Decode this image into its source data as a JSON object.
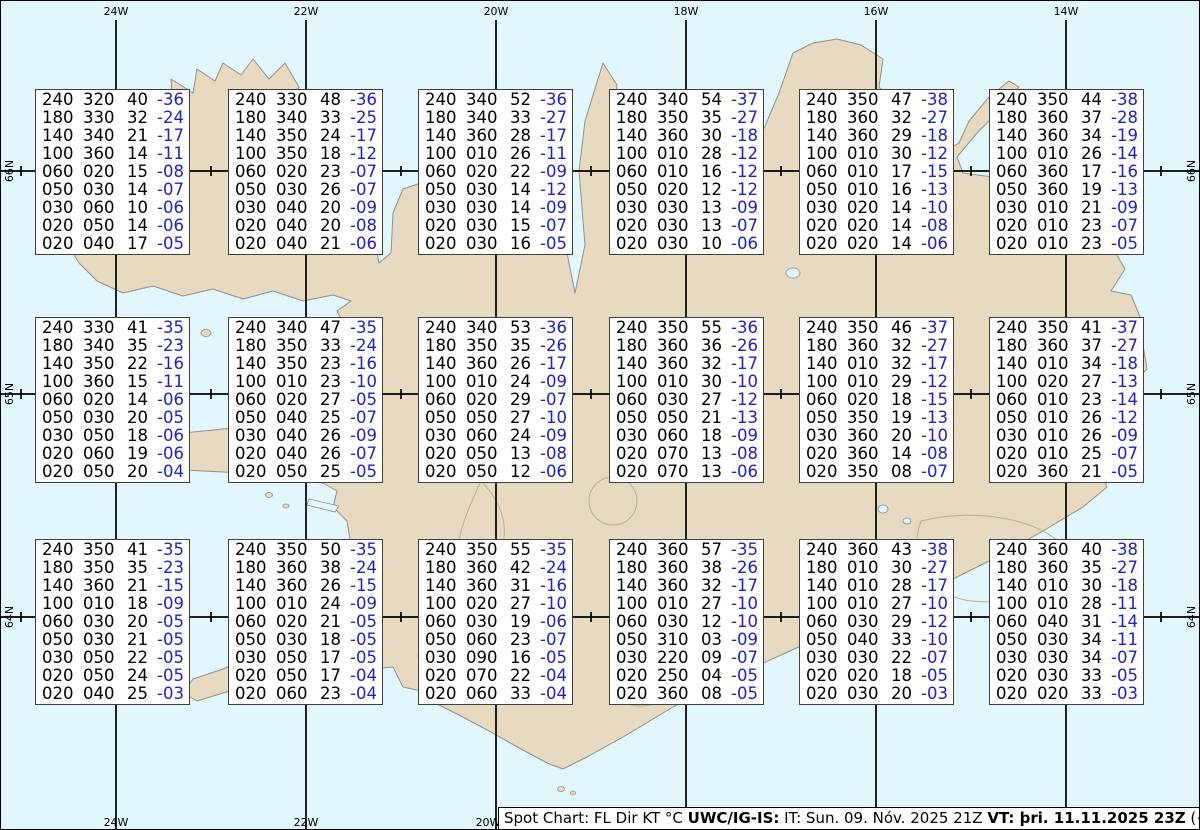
{
  "graticule": {
    "top_labels": [
      "24W",
      "22W",
      "20W",
      "18W",
      "16W",
      "14W"
    ],
    "bottom_labels": [
      "24W",
      "22W",
      "20W"
    ],
    "left_labels": [
      "66N",
      "65N",
      "64N"
    ],
    "right_labels": [
      "66N",
      "65N",
      "64N"
    ]
  },
  "legend_columns": [
    "FL",
    "Dir",
    "KT",
    "°C"
  ],
  "colors": {
    "water": "#e1f7fc",
    "land": "#e8d9c1",
    "coastline": "#919191",
    "temperature_blue": "#2222bf",
    "grid_black": "#000000",
    "box_border": "#3f3f3f"
  },
  "spot_boxes": [
    {
      "rows": [
        [
          "240",
          "320",
          "40",
          "-36"
        ],
        [
          "180",
          "330",
          "32",
          "-24"
        ],
        [
          "140",
          "340",
          "21",
          "-17"
        ],
        [
          "100",
          "360",
          "14",
          "-11"
        ],
        [
          "060",
          "020",
          "15",
          "-08"
        ],
        [
          "050",
          "030",
          "14",
          "-07"
        ],
        [
          "030",
          "060",
          "10",
          "-06"
        ],
        [
          "020",
          "050",
          "14",
          "-06"
        ],
        [
          "020",
          "040",
          "17",
          "-05"
        ]
      ]
    },
    {
      "rows": [
        [
          "240",
          "330",
          "48",
          "-36"
        ],
        [
          "180",
          "340",
          "33",
          "-25"
        ],
        [
          "140",
          "350",
          "24",
          "-17"
        ],
        [
          "100",
          "350",
          "18",
          "-12"
        ],
        [
          "060",
          "020",
          "23",
          "-07"
        ],
        [
          "050",
          "030",
          "26",
          "-07"
        ],
        [
          "030",
          "040",
          "20",
          "-09"
        ],
        [
          "020",
          "040",
          "20",
          "-08"
        ],
        [
          "020",
          "040",
          "21",
          "-06"
        ]
      ]
    },
    {
      "rows": [
        [
          "240",
          "340",
          "52",
          "-36"
        ],
        [
          "180",
          "340",
          "33",
          "-27"
        ],
        [
          "140",
          "360",
          "28",
          "-17"
        ],
        [
          "100",
          "010",
          "26",
          "-11"
        ],
        [
          "060",
          "020",
          "22",
          "-09"
        ],
        [
          "050",
          "030",
          "14",
          "-12"
        ],
        [
          "030",
          "030",
          "14",
          "-09"
        ],
        [
          "020",
          "030",
          "15",
          "-07"
        ],
        [
          "020",
          "030",
          "16",
          "-05"
        ]
      ]
    },
    {
      "rows": [
        [
          "240",
          "340",
          "54",
          "-37"
        ],
        [
          "180",
          "350",
          "35",
          "-27"
        ],
        [
          "140",
          "360",
          "30",
          "-18"
        ],
        [
          "100",
          "010",
          "28",
          "-12"
        ],
        [
          "060",
          "010",
          "16",
          "-12"
        ],
        [
          "050",
          "020",
          "12",
          "-12"
        ],
        [
          "030",
          "030",
          "13",
          "-09"
        ],
        [
          "020",
          "030",
          "13",
          "-07"
        ],
        [
          "020",
          "030",
          "10",
          "-06"
        ]
      ]
    },
    {
      "rows": [
        [
          "240",
          "350",
          "47",
          "-38"
        ],
        [
          "180",
          "360",
          "32",
          "-27"
        ],
        [
          "140",
          "360",
          "29",
          "-18"
        ],
        [
          "100",
          "010",
          "30",
          "-12"
        ],
        [
          "060",
          "010",
          "17",
          "-15"
        ],
        [
          "050",
          "010",
          "16",
          "-13"
        ],
        [
          "030",
          "020",
          "14",
          "-10"
        ],
        [
          "020",
          "020",
          "14",
          "-08"
        ],
        [
          "020",
          "020",
          "14",
          "-06"
        ]
      ]
    },
    {
      "rows": [
        [
          "240",
          "350",
          "44",
          "-38"
        ],
        [
          "180",
          "360",
          "37",
          "-28"
        ],
        [
          "140",
          "360",
          "34",
          "-19"
        ],
        [
          "100",
          "010",
          "26",
          "-14"
        ],
        [
          "060",
          "360",
          "17",
          "-16"
        ],
        [
          "050",
          "360",
          "19",
          "-13"
        ],
        [
          "030",
          "010",
          "21",
          "-09"
        ],
        [
          "020",
          "010",
          "23",
          "-07"
        ],
        [
          "020",
          "010",
          "23",
          "-05"
        ]
      ]
    },
    {
      "rows": [
        [
          "240",
          "330",
          "41",
          "-35"
        ],
        [
          "180",
          "340",
          "35",
          "-23"
        ],
        [
          "140",
          "350",
          "22",
          "-16"
        ],
        [
          "100",
          "360",
          "15",
          "-11"
        ],
        [
          "060",
          "020",
          "14",
          "-06"
        ],
        [
          "050",
          "030",
          "20",
          "-05"
        ],
        [
          "030",
          "050",
          "18",
          "-06"
        ],
        [
          "020",
          "060",
          "19",
          "-06"
        ],
        [
          "020",
          "050",
          "20",
          "-04"
        ]
      ]
    },
    {
      "rows": [
        [
          "240",
          "340",
          "47",
          "-35"
        ],
        [
          "180",
          "350",
          "33",
          "-24"
        ],
        [
          "140",
          "350",
          "23",
          "-16"
        ],
        [
          "100",
          "010",
          "23",
          "-10"
        ],
        [
          "060",
          "020",
          "27",
          "-05"
        ],
        [
          "050",
          "040",
          "25",
          "-07"
        ],
        [
          "030",
          "040",
          "26",
          "-09"
        ],
        [
          "020",
          "040",
          "26",
          "-07"
        ],
        [
          "020",
          "050",
          "25",
          "-05"
        ]
      ]
    },
    {
      "rows": [
        [
          "240",
          "340",
          "53",
          "-36"
        ],
        [
          "180",
          "350",
          "35",
          "-26"
        ],
        [
          "140",
          "360",
          "26",
          "-17"
        ],
        [
          "100",
          "010",
          "24",
          "-09"
        ],
        [
          "060",
          "020",
          "29",
          "-07"
        ],
        [
          "050",
          "050",
          "27",
          "-10"
        ],
        [
          "030",
          "060",
          "24",
          "-09"
        ],
        [
          "020",
          "050",
          "13",
          "-08"
        ],
        [
          "020",
          "050",
          "12",
          "-06"
        ]
      ]
    },
    {
      "rows": [
        [
          "240",
          "350",
          "55",
          "-36"
        ],
        [
          "180",
          "360",
          "36",
          "-26"
        ],
        [
          "140",
          "360",
          "32",
          "-17"
        ],
        [
          "100",
          "010",
          "30",
          "-10"
        ],
        [
          "060",
          "030",
          "27",
          "-12"
        ],
        [
          "050",
          "050",
          "21",
          "-13"
        ],
        [
          "030",
          "060",
          "18",
          "-09"
        ],
        [
          "020",
          "070",
          "13",
          "-08"
        ],
        [
          "020",
          "070",
          "13",
          "-06"
        ]
      ]
    },
    {
      "rows": [
        [
          "240",
          "350",
          "46",
          "-37"
        ],
        [
          "180",
          "360",
          "32",
          "-27"
        ],
        [
          "140",
          "010",
          "32",
          "-17"
        ],
        [
          "100",
          "010",
          "29",
          "-12"
        ],
        [
          "060",
          "020",
          "18",
          "-15"
        ],
        [
          "050",
          "350",
          "19",
          "-13"
        ],
        [
          "030",
          "360",
          "20",
          "-10"
        ],
        [
          "020",
          "360",
          "14",
          "-08"
        ],
        [
          "020",
          "350",
          "08",
          "-07"
        ]
      ]
    },
    {
      "rows": [
        [
          "240",
          "350",
          "41",
          "-37"
        ],
        [
          "180",
          "360",
          "37",
          "-27"
        ],
        [
          "140",
          "010",
          "34",
          "-18"
        ],
        [
          "100",
          "020",
          "27",
          "-13"
        ],
        [
          "060",
          "010",
          "23",
          "-14"
        ],
        [
          "050",
          "010",
          "26",
          "-12"
        ],
        [
          "030",
          "010",
          "26",
          "-09"
        ],
        [
          "020",
          "010",
          "25",
          "-07"
        ],
        [
          "020",
          "360",
          "21",
          "-05"
        ]
      ]
    },
    {
      "rows": [
        [
          "240",
          "350",
          "41",
          "-35"
        ],
        [
          "180",
          "350",
          "35",
          "-23"
        ],
        [
          "140",
          "360",
          "21",
          "-15"
        ],
        [
          "100",
          "010",
          "18",
          "-09"
        ],
        [
          "060",
          "030",
          "20",
          "-05"
        ],
        [
          "050",
          "030",
          "21",
          "-05"
        ],
        [
          "030",
          "050",
          "22",
          "-05"
        ],
        [
          "020",
          "050",
          "24",
          "-05"
        ],
        [
          "020",
          "040",
          "25",
          "-03"
        ]
      ]
    },
    {
      "rows": [
        [
          "240",
          "350",
          "50",
          "-35"
        ],
        [
          "180",
          "360",
          "38",
          "-24"
        ],
        [
          "140",
          "360",
          "26",
          "-15"
        ],
        [
          "100",
          "010",
          "24",
          "-09"
        ],
        [
          "060",
          "020",
          "21",
          "-05"
        ],
        [
          "050",
          "030",
          "18",
          "-05"
        ],
        [
          "030",
          "050",
          "17",
          "-05"
        ],
        [
          "020",
          "050",
          "17",
          "-04"
        ],
        [
          "020",
          "060",
          "23",
          "-04"
        ]
      ]
    },
    {
      "rows": [
        [
          "240",
          "350",
          "55",
          "-35"
        ],
        [
          "180",
          "360",
          "42",
          "-24"
        ],
        [
          "140",
          "360",
          "31",
          "-16"
        ],
        [
          "100",
          "020",
          "27",
          "-10"
        ],
        [
          "060",
          "030",
          "19",
          "-06"
        ],
        [
          "050",
          "060",
          "23",
          "-07"
        ],
        [
          "030",
          "090",
          "16",
          "-05"
        ],
        [
          "020",
          "070",
          "22",
          "-04"
        ],
        [
          "020",
          "060",
          "33",
          "-04"
        ]
      ]
    },
    {
      "rows": [
        [
          "240",
          "360",
          "57",
          "-35"
        ],
        [
          "180",
          "360",
          "38",
          "-26"
        ],
        [
          "140",
          "360",
          "32",
          "-17"
        ],
        [
          "100",
          "010",
          "27",
          "-10"
        ],
        [
          "060",
          "030",
          "12",
          "-10"
        ],
        [
          "050",
          "310",
          "03",
          "-09"
        ],
        [
          "030",
          "220",
          "09",
          "-07"
        ],
        [
          "020",
          "250",
          "04",
          "-05"
        ],
        [
          "020",
          "360",
          "08",
          "-05"
        ]
      ]
    },
    {
      "rows": [
        [
          "240",
          "360",
          "43",
          "-38"
        ],
        [
          "180",
          "010",
          "30",
          "-27"
        ],
        [
          "140",
          "010",
          "28",
          "-17"
        ],
        [
          "100",
          "010",
          "27",
          "-10"
        ],
        [
          "060",
          "030",
          "29",
          "-12"
        ],
        [
          "050",
          "040",
          "33",
          "-10"
        ],
        [
          "030",
          "030",
          "22",
          "-07"
        ],
        [
          "020",
          "020",
          "18",
          "-05"
        ],
        [
          "020",
          "030",
          "20",
          "-03"
        ]
      ]
    },
    {
      "rows": [
        [
          "240",
          "360",
          "40",
          "-38"
        ],
        [
          "180",
          "360",
          "35",
          "-27"
        ],
        [
          "140",
          "010",
          "30",
          "-18"
        ],
        [
          "100",
          "010",
          "28",
          "-11"
        ],
        [
          "060",
          "040",
          "31",
          "-14"
        ],
        [
          "050",
          "030",
          "34",
          "-11"
        ],
        [
          "030",
          "030",
          "34",
          "-07"
        ],
        [
          "020",
          "030",
          "33",
          "-05"
        ],
        [
          "020",
          "020",
          "33",
          "-03"
        ]
      ]
    }
  ],
  "footer": {
    "segments": [
      {
        "text": "Spot Chart: FL Dir KT °C ",
        "bold": false
      },
      {
        "text": "UWC/IG-IS:",
        "bold": true
      },
      {
        "text": " IT: Sun. 09. Nóv. 2025 21Z ",
        "bold": false
      },
      {
        "text": "VT: þri. 11.11.2025 23Z",
        "bold": true
      },
      {
        "text": " (+50 h)",
        "bold": false
      }
    ]
  }
}
